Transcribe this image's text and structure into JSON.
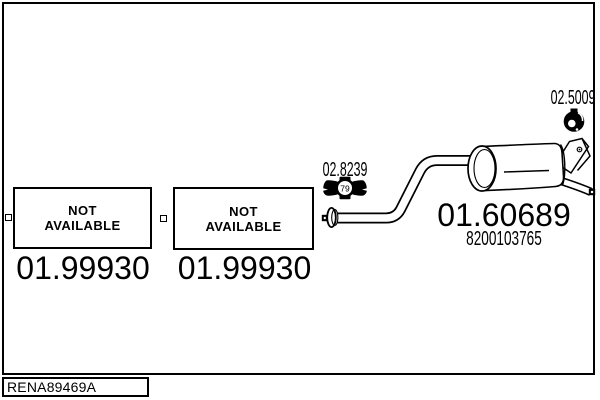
{
  "colors": {
    "line": "#000000",
    "background": "#ffffff"
  },
  "boxes": {
    "left": {
      "label_line1": "NOT",
      "label_line2": "AVAILABLE",
      "part_number": "01.99930"
    },
    "middle": {
      "label_line1": "NOT",
      "label_line2": "AVAILABLE",
      "part_number": "01.99930"
    }
  },
  "clamp": {
    "part_number": "02.8239",
    "icon_text": "79"
  },
  "hanger": {
    "part_number": "02.5009"
  },
  "muffler": {
    "part_number": "01.60689",
    "oem_number": "8200103765"
  },
  "footer": {
    "drawing_code": "RENA89469A"
  }
}
